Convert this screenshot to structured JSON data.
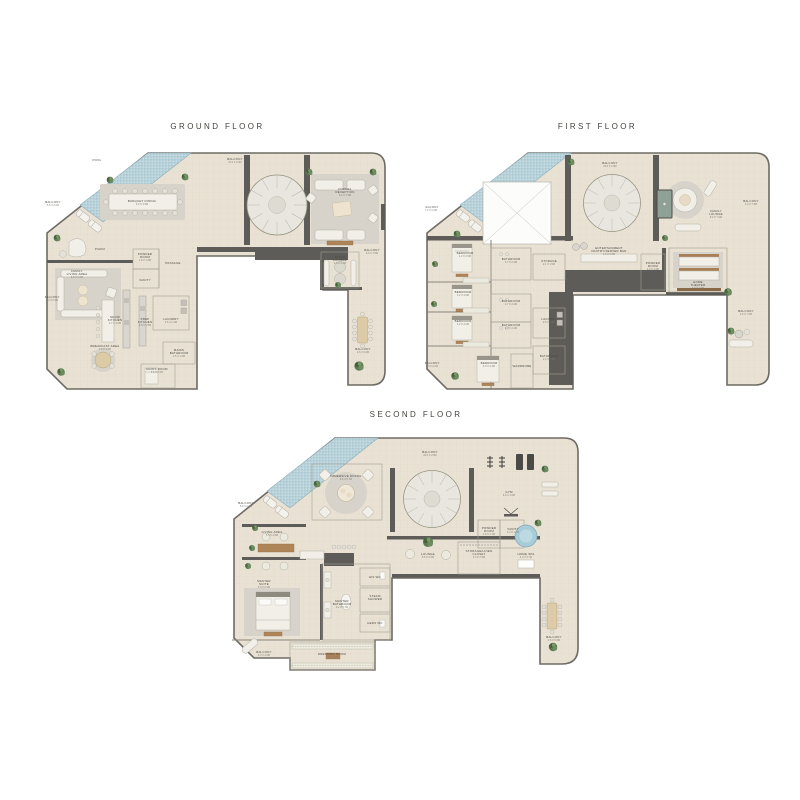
{
  "colors": {
    "floor": "#e9e2d4",
    "wall": "#5d5c58",
    "pool_water": "#b9d2da",
    "plant_green": "#5a7b50",
    "spa_water": "#a8cdd9"
  },
  "floors": [
    {
      "title": "GROUND FLOOR",
      "labels": [
        {
          "t": "POOL",
          "x": 52,
          "y": 11
        },
        {
          "t": "BALCONY",
          "d": "21.0 X 2.0M",
          "x": 190,
          "y": 10
        },
        {
          "t": "BALCONY",
          "d": "5.5 X 2.0M",
          "x": 8,
          "y": 53
        },
        {
          "t": "BANQUET DINING",
          "d": "9.0 X 3.5M",
          "x": 97,
          "y": 52
        },
        {
          "t": "FORMAL",
          "t2": "RECEPTION",
          "d": "8.2 X 7.0M",
          "x": 300,
          "y": 40
        },
        {
          "t": "CIGAR",
          "t2": "LOUNGE",
          "d": "4.0 X 3.6M",
          "x": 295,
          "y": 108
        },
        {
          "t": "BALCONY",
          "d": "3.0 X 7.5M",
          "x": 327,
          "y": 101
        },
        {
          "t": "PIANO",
          "x": 55,
          "y": 100
        },
        {
          "t": "POWDER",
          "t2": "ROOM",
          "d": "1.8 X 1.6M",
          "x": 100,
          "y": 105
        },
        {
          "t": "PASSAGE",
          "x": 128,
          "y": 114
        },
        {
          "t": "VANITY",
          "x": 100,
          "y": 131
        },
        {
          "t": "FAMILY",
          "t2": "LIVING AREA",
          "d": "5.8 X 6.0M",
          "x": 32,
          "y": 122
        },
        {
          "t": "BALCONY",
          "d": "2.0 X 5.5M",
          "x": 7,
          "y": 148
        },
        {
          "t": "SHOW",
          "t2": "KITCHEN",
          "d": "3.7 X 4.5M",
          "x": 70,
          "y": 168
        },
        {
          "t": "PREP",
          "t2": "KITCHEN",
          "d": "3.5 X 4.5M",
          "x": 100,
          "y": 170
        },
        {
          "t": "LAUNDRY",
          "d": "2.6 X 2.2M",
          "x": 126,
          "y": 170
        },
        {
          "t": "BREAKFAST AREA",
          "d": "3.0 X 3.0M",
          "x": 60,
          "y": 197
        },
        {
          "t": "MAIDS",
          "t2": "BATHROOM",
          "d": "2.5 X 1.6M",
          "x": 134,
          "y": 201
        },
        {
          "t": "MAIDS ROOM",
          "d": "3.0 X 2.5M",
          "x": 112,
          "y": 220
        },
        {
          "t": "BALCONY",
          "d": "2.6 X 9.0M",
          "x": 318,
          "y": 200
        }
      ]
    },
    {
      "title": "FIRST FLOOR",
      "labels": [
        {
          "t": "BALCONY",
          "d": "20.0 X 2.0M",
          "x": 185,
          "y": 14
        },
        {
          "t": "BALCONY",
          "d": "7.2 X 2.0M",
          "x": 6,
          "y": 58
        },
        {
          "t": "FAMILY",
          "t2": "LOUNGE",
          "d": "8.2 X 7.0M",
          "x": 291,
          "y": 62
        },
        {
          "t": "BALCONY",
          "d": "3.0 X 7.5M",
          "x": 326,
          "y": 52
        },
        {
          "t": "BEDROOM",
          "d": "4.2 X 4.5M",
          "x": 40,
          "y": 104
        },
        {
          "t": "BATHROOM",
          "d": "2.7 X 2.2M",
          "x": 86,
          "y": 110
        },
        {
          "t": "STORAGE",
          "d": "2.1 X 1.5M",
          "x": 124,
          "y": 112
        },
        {
          "t": "ENTERTAINMENT",
          "t2": "PANTRY/SERVER BAR",
          "d": "4.6 X 2.0M",
          "x": 184,
          "y": 99
        },
        {
          "t": "POWDER",
          "t2": "ROOM",
          "d": "2.4 X 1.6M",
          "x": 228,
          "y": 114
        },
        {
          "t": "HOME",
          "t2": "THEATER",
          "d": "7.0 X 4.5M",
          "x": 273,
          "y": 133
        },
        {
          "t": "BEDROOM",
          "d": "4.2 X 4.0M",
          "x": 38,
          "y": 143
        },
        {
          "t": "BATHROOM",
          "d": "2.7 X 2.2M",
          "x": 86,
          "y": 152
        },
        {
          "t": "BEDROOM",
          "d": "4.2 X 4.0M",
          "x": 38,
          "y": 172
        },
        {
          "t": "BATHROOM",
          "d": "2.7 X 2.2M",
          "x": 86,
          "y": 176
        },
        {
          "t": "LAUNDRY",
          "d": "2.6 X 2.2M",
          "x": 124,
          "y": 170
        },
        {
          "t": "BALCONY",
          "d": "2.6 X 7.0M",
          "x": 321,
          "y": 162
        },
        {
          "t": "BEDROOM",
          "d": "4.0 X 3.2M",
          "x": 64,
          "y": 214
        },
        {
          "t": "WARDROBE",
          "x": 97,
          "y": 217
        },
        {
          "t": "BATHROOM",
          "d": "2.4 X 1.6M",
          "x": 124,
          "y": 207
        },
        {
          "t": "BALCONY",
          "d": "6.0 X 2.0M",
          "x": 7,
          "y": 214
        }
      ]
    },
    {
      "title": "SECOND FLOOR",
      "labels": [
        {
          "t": "BALCONY",
          "d": "20.0 X 2.0M",
          "x": 198,
          "y": 17
        },
        {
          "t": "IMMERSIVE DINING",
          "d": "6.0 X 5.7M",
          "x": 114,
          "y": 41
        },
        {
          "t": "BALCONY",
          "d": "5.0 X 2.0M",
          "x": 14,
          "y": 68
        },
        {
          "t": "GYM",
          "d": "6.0 X 4.0M",
          "x": 277,
          "y": 57
        },
        {
          "t": "LIVING AREA",
          "d": "5.5 X 4.5M",
          "x": 40,
          "y": 97
        },
        {
          "t": "POWDER",
          "t2": "ROOM",
          "d": "1.8 X 1.7M",
          "x": 257,
          "y": 93
        },
        {
          "t": "VANITY",
          "d": "2.0 X 1.7M",
          "x": 281,
          "y": 94
        },
        {
          "t": "LOUNGE",
          "d": "5.5 X 2.5M",
          "x": 196,
          "y": 119
        },
        {
          "t": "STORAGE/LINEN",
          "t2": "CLOSET",
          "d": "4.4 X 2.5M",
          "x": 247,
          "y": 116
        },
        {
          "t": "HOME SPA",
          "d": "4.0 X 3.7M",
          "x": 294,
          "y": 119
        },
        {
          "t": "MASTER",
          "t2": "SUITE",
          "d": "6.0 X 6.0M",
          "x": 32,
          "y": 146
        },
        {
          "t": "HIS WC",
          "x": 143,
          "y": 142
        },
        {
          "t": "MASTER",
          "t2": "BATHROOM",
          "d": "4.2 X 5.7M",
          "x": 110,
          "y": 166
        },
        {
          "t": "STEAM",
          "t2": "SHOWER",
          "x": 143,
          "y": 161
        },
        {
          "t": "HERS WC",
          "x": 143,
          "y": 188
        },
        {
          "t": "DRESSING ROOM",
          "d": "7.0 X 3.2M",
          "x": 100,
          "y": 219
        },
        {
          "t": "BALCONY",
          "d": "6.0 X 2.0M",
          "x": 32,
          "y": 217
        },
        {
          "t": "BALCONY",
          "d": "2.6 X 6.0M",
          "x": 322,
          "y": 202
        }
      ]
    }
  ]
}
